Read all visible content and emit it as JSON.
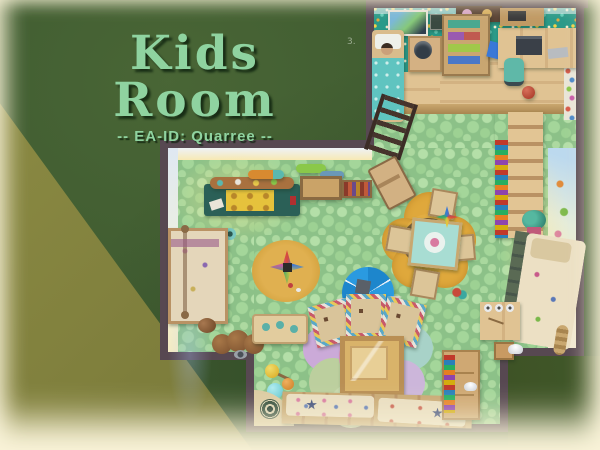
{
  "scene": {
    "game": "top-down room build screenshot",
    "watermark": "3."
  },
  "title": {
    "text": "Kids Room",
    "subtitle": "-- EA-ID: Quarree --"
  },
  "palette": {
    "grass_dark": "#3e5a30",
    "grass_olive": "#85853f",
    "title_text": "#8fd3a0",
    "wall": "#574851",
    "carpet_pebble_green": "#8cc188",
    "floor_confetti_teal": "#2a9a89",
    "wood_floor": "#d9b98a",
    "vignette_cream": "#f9f3d8",
    "rug_yellow": "#dfa83c",
    "rug_pink": "#e7aec0",
    "umbrella_blue": "#1d86cc",
    "craft_table_teal": "#2b6057"
  },
  "loft": {
    "items": [
      "wall-poster",
      "dark-poster",
      "clutter-shelf",
      "bed-with-sleeping-sim",
      "nightstand-lamp",
      "open-dresser",
      "tablet",
      "desk-with-laptop",
      "printer-shelf",
      "desk-chair",
      "red-ball",
      "wall-stickers",
      "ladder",
      "wood-platform"
    ]
  },
  "playroom": {
    "items": [
      "activity-table",
      "wall-shelf-plane",
      "wall-shelf-fish",
      "crate-shelf",
      "mini-bookshelf",
      "round-play-rug",
      "star-toy",
      "flower-rug",
      "kids-table",
      "kids-chairs",
      "play-umbrella",
      "petal-rug",
      "kid-armchairs",
      "toy-chest-table",
      "balloon-lamp",
      "corner-dart-rug",
      "daybed-bench",
      "canopy-bed",
      "plush-toy",
      "pet-bed",
      "pet-bowl",
      "nursery-shelf",
      "bookshelf-stairs",
      "potted-plant",
      "wall-mural",
      "bed",
      "kids-desk",
      "stool",
      "wall-light",
      "bookcase",
      "easel-chair"
    ]
  }
}
